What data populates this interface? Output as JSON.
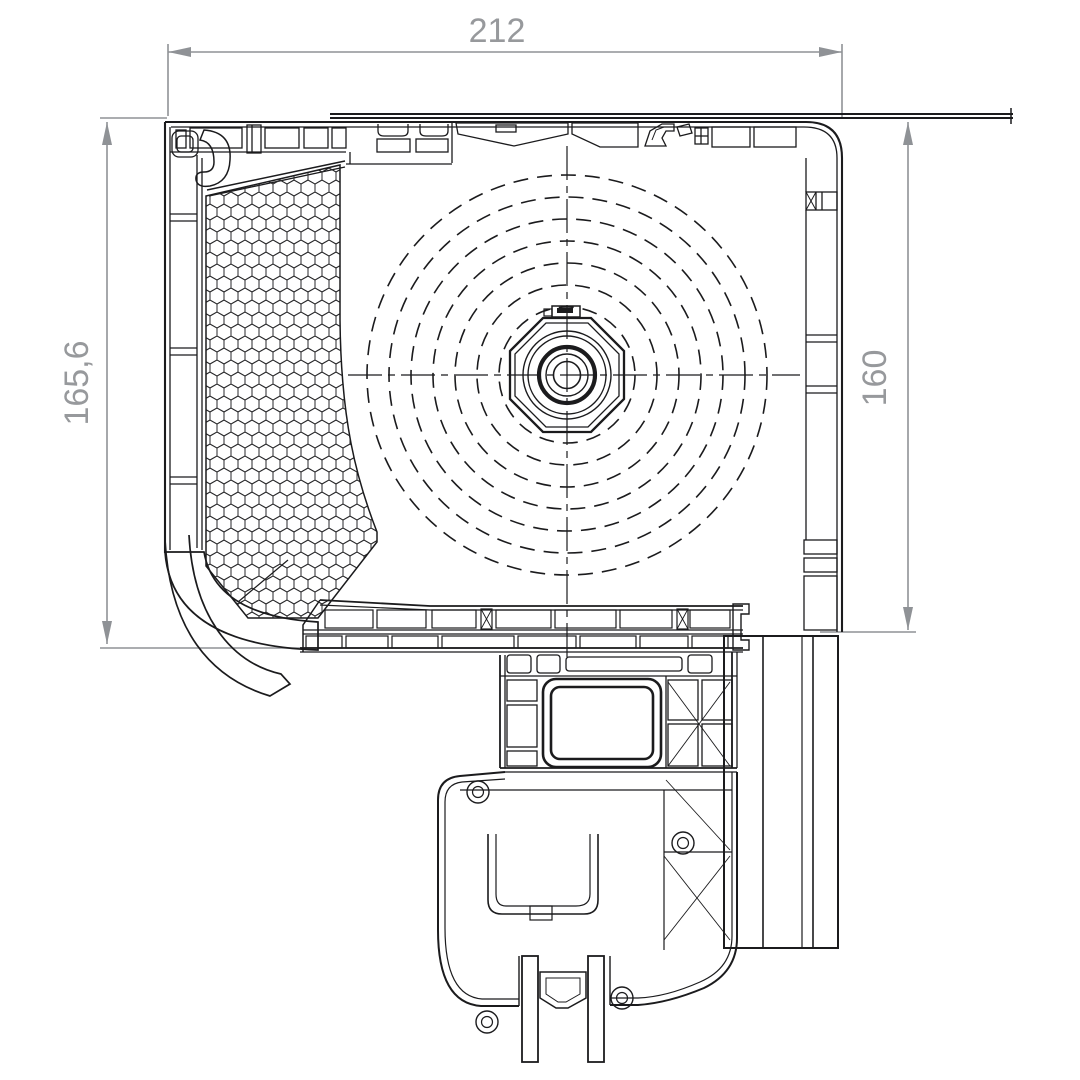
{
  "drawing": {
    "type": "technical-section",
    "subject": "roller-shutter-box-cross-section",
    "dimensions": [
      {
        "id": "overall-width",
        "label": "212",
        "orientation": "horizontal",
        "position": "top"
      },
      {
        "id": "overall-height",
        "label": "165,6",
        "orientation": "vertical",
        "position": "left"
      },
      {
        "id": "inner-height",
        "label": "160",
        "orientation": "vertical",
        "position": "right"
      }
    ],
    "colors": {
      "background": "#ffffff",
      "profile_line": "#1b1b1d",
      "dimension_line": "#8f9296",
      "dimension_text": "#97999c"
    },
    "elements": {
      "coil_dashed_circle_radii": [
        68,
        90,
        112,
        134,
        156,
        178,
        200
      ],
      "hub_circle_radii": [
        44,
        39,
        28,
        21,
        13.5
      ]
    }
  }
}
